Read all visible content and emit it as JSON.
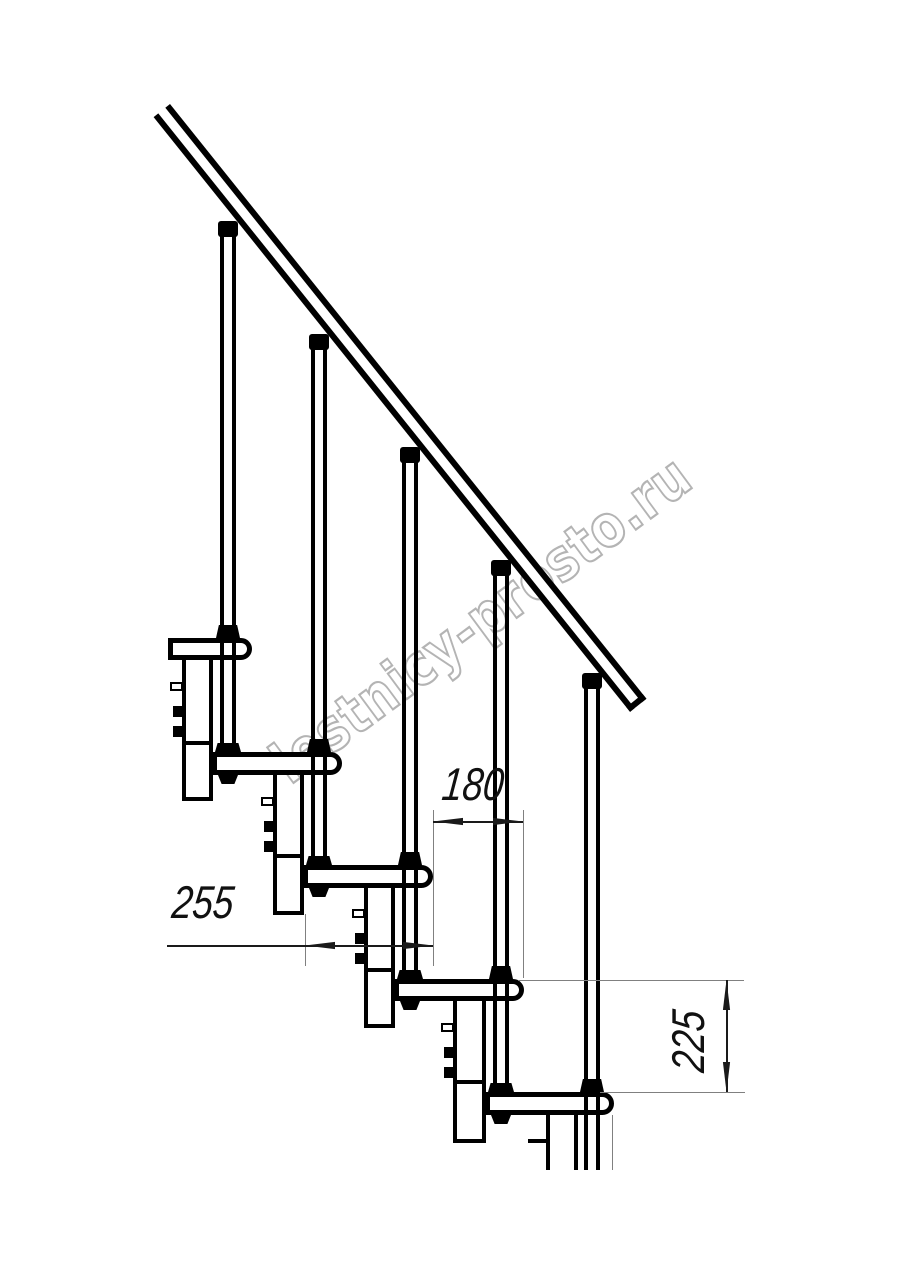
{
  "watermark": {
    "text": "lestnicy-prosto.ru",
    "color": "#b4b4b4"
  },
  "dimensions": {
    "going": {
      "label": "180"
    },
    "depth": {
      "label": "255"
    },
    "riser": {
      "label": "225"
    }
  },
  "colors": {
    "line": "#000000",
    "dim_line": "#1a1a1a",
    "ext_line": "#808080",
    "text": "#111111"
  },
  "drawing": {
    "handrail": {
      "x": 170,
      "y": 104,
      "length": 762,
      "thickness": 21,
      "angle": 51.3,
      "stroke": 6
    },
    "treads": [
      {
        "x": 168,
        "y": 638,
        "w": 84,
        "h": 22
      },
      {
        "x": 212,
        "y": 752,
        "w": 130,
        "h": 23
      },
      {
        "x": 303,
        "y": 865,
        "w": 130,
        "h": 23
      },
      {
        "x": 394,
        "y": 979,
        "w": 130,
        "h": 22
      },
      {
        "x": 485,
        "y": 1092,
        "w": 129,
        "h": 23
      }
    ],
    "columns": [
      {
        "x": 182,
        "y": 660,
        "w": 31,
        "h": 141,
        "div_y": 741,
        "closed": true,
        "fittings": true
      },
      {
        "x": 273,
        "y": 775,
        "w": 31,
        "h": 140,
        "div_y": 854,
        "closed": true,
        "fittings": true
      },
      {
        "x": 364,
        "y": 887,
        "w": 31,
        "h": 141,
        "div_y": 968,
        "closed": true,
        "fittings": true
      },
      {
        "x": 453,
        "y": 1001,
        "w": 33,
        "h": 142,
        "div_y": 1080,
        "closed": true,
        "fittings": true
      },
      {
        "x": 546,
        "y": 1114,
        "w": 32,
        "h": 56,
        "div_y": null,
        "closed": false,
        "fittings": false
      }
    ],
    "balusters": [
      {
        "cx": 228,
        "collar_top": 221,
        "shaft_top": 236,
        "shaft_bottom": 752,
        "thru_tread": 0,
        "base_tread": 1
      },
      {
        "cx": 319,
        "collar_top": 334,
        "shaft_top": 349,
        "shaft_bottom": 865,
        "thru_tread": 1,
        "base_tread": 2
      },
      {
        "cx": 410,
        "collar_top": 447,
        "shaft_top": 462,
        "shaft_bottom": 979,
        "thru_tread": 2,
        "base_tread": 3
      },
      {
        "cx": 501,
        "collar_top": 560,
        "shaft_top": 575,
        "shaft_bottom": 1092,
        "thru_tread": 3,
        "base_tread": 4
      },
      {
        "cx": 592,
        "collar_top": 673,
        "shaft_top": 688,
        "shaft_bottom": 1170,
        "thru_tread": 4,
        "base_tread": null
      }
    ],
    "extra_lines": [
      {
        "x": 528,
        "y": 1139,
        "w": 19,
        "h": 4,
        "color": "#000000"
      },
      {
        "x": 612,
        "y": 1115,
        "w": 1,
        "h": 55,
        "color": "#808080"
      }
    ],
    "dims": [
      {
        "name": "going-180",
        "ext": [
          {
            "x": 433,
            "y1": 810,
            "y2": 966
          },
          {
            "x": 523,
            "y1": 810,
            "y2": 978
          }
        ],
        "lines": [
          {
            "x1": 433,
            "x2": 523,
            "y": 822
          }
        ],
        "arrows": [
          {
            "dir": "left",
            "x": 433,
            "y": 822
          },
          {
            "dir": "right",
            "x": 523,
            "y": 822
          }
        ]
      },
      {
        "name": "depth-255",
        "ext": [
          {
            "x": 305,
            "y1": 914,
            "y2": 966
          }
        ],
        "lines": [
          {
            "x1": 167,
            "x2": 433,
            "y": 946
          }
        ],
        "arrows": [
          {
            "dir": "left",
            "x": 305,
            "y": 946
          },
          {
            "dir": "right",
            "x": 433,
            "y": 946
          }
        ]
      },
      {
        "name": "riser-225",
        "ext": [
          {
            "y": 980,
            "x1": 518,
            "x2": 744
          },
          {
            "y": 1092,
            "x1": 600,
            "x2": 745
          }
        ],
        "lines": [
          {
            "x": 727,
            "y1": 980,
            "y2": 1092
          }
        ],
        "arrows": [
          {
            "dir": "up",
            "x": 727,
            "y": 980
          },
          {
            "dir": "down",
            "x": 727,
            "y": 1092
          }
        ]
      }
    ]
  }
}
